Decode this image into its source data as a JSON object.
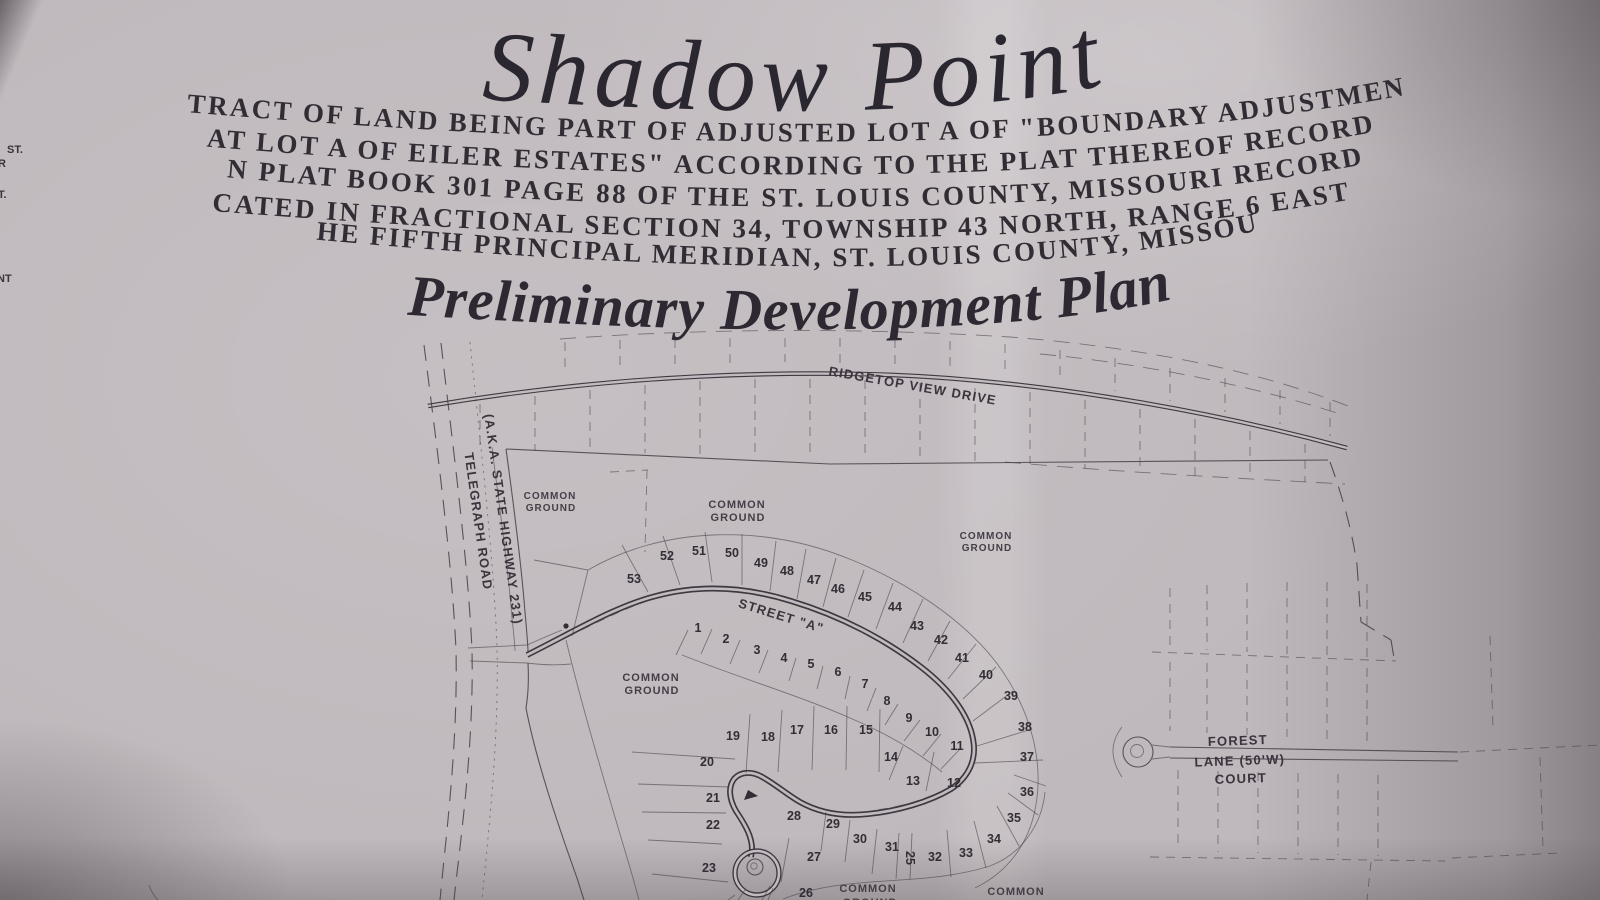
{
  "document": {
    "title": "Shadow Point",
    "legal_description": {
      "line1": "A TRACT OF LAND BEING PART OF ADJUSTED LOT A OF \"BOUNDARY ADJUSTMENT",
      "line2": "PLAT LOT A OF EILER ESTATES\" ACCORDING TO THE PLAT THEREOF RECORDED",
      "line3": "IN PLAT BOOK 301 PAGE 88 OF THE ST. LOUIS COUNTY, MISSOURI RECORDS,",
      "line4": "LOCATED IN FRACTIONAL SECTION 34, TOWNSHIP 43 NORTH, RANGE 6 EAST OF",
      "line5": "THE FIFTH PRINCIPAL MERIDIAN, ST. LOUIS COUNTY, MISSOURI"
    },
    "subtitle": "Preliminary Development Plan"
  },
  "edge_fragments": {
    "f1": "ST.",
    "f2": "R",
    "f3": "T.",
    "f4": "NT"
  },
  "map": {
    "roads": {
      "ridgetop_view_drive": "RIDGETOP VIEW DRIVE",
      "telegraph_road": "TELEGRAPH ROAD",
      "telegraph_aka": "(A.K.A. STATE HIGHWAY 231)",
      "street_a": "STREET \"A\"",
      "forest_lane_line1": "FOREST",
      "forest_lane_line2": "LANE (50'W)",
      "forest_lane_line3": "COURT"
    },
    "labels": {
      "common": "COMMON",
      "ground": "GROUND"
    },
    "lots": {
      "1": "1",
      "2": "2",
      "3": "3",
      "4": "4",
      "5": "5",
      "6": "6",
      "7": "7",
      "8": "8",
      "9": "9",
      "10": "10",
      "11": "11",
      "12": "12",
      "13": "13",
      "14": "14",
      "15": "15",
      "16": "16",
      "17": "17",
      "18": "18",
      "19": "19",
      "20": "20",
      "21": "21",
      "22": "22",
      "23": "23",
      "25": "25",
      "26": "26",
      "27": "27",
      "28": "28",
      "29": "29",
      "30": "30",
      "31": "31",
      "32": "32",
      "33": "33",
      "34": "34",
      "35": "35",
      "36": "36",
      "37": "37",
      "38": "38",
      "39": "39",
      "40": "40",
      "41": "41",
      "42": "42",
      "43": "43",
      "44": "44",
      "45": "45",
      "46": "46",
      "47": "47",
      "48": "48",
      "49": "49",
      "50": "50",
      "51": "51",
      "52": "52",
      "53": "53"
    }
  },
  "colors": {
    "paper": "#c3bcc0",
    "ink": "#38313a"
  }
}
